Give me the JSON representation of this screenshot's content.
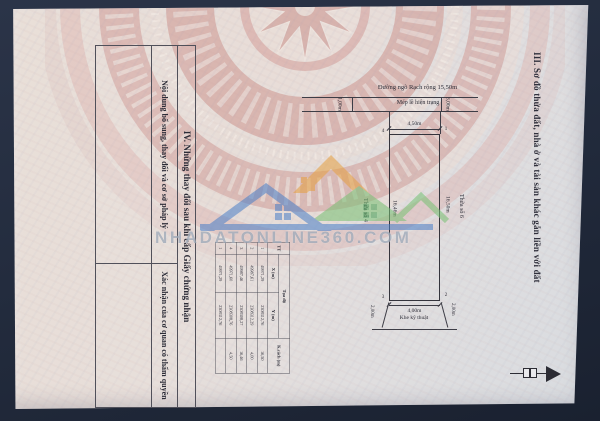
{
  "page": {
    "section3_title": "III. Sơ đồ thửa đất, nhà ở và tài sản khác gắn liền với đất",
    "section4": {
      "heading": "IV. Những thay đổi sau khi cấp Giấy chứng nhận",
      "col1": "Nội dung bổ sung, thay đổi và cơ sở pháp lý",
      "col2": "Xác nhận của cơ quan có thẩm quyền"
    },
    "diagram": {
      "road_label": "Đường ngõ Rạch rộng 15,50m",
      "edge_label": "Mép lề hiện trạng",
      "left_offset": "1,00m",
      "right_offset": "3,00m",
      "top_dim": "4,50m",
      "bottom_dim": "4,00m",
      "left_dim": "16,46m",
      "right_dim": "16,50m",
      "left_plot": "Thửa số 4",
      "right_plot": "Thửa số 6",
      "gap_left": "2,00m",
      "gap_right": "2,00m",
      "gap_label": "Khe kỹ thuật",
      "corners": {
        "tl": "4",
        "tr": "1",
        "bl": "3",
        "br": "2"
      }
    },
    "coord_table": {
      "tt_header": "TT",
      "toado_header": "Tọa độ",
      "x_header": "X (m)",
      "y_header": "Y (m)",
      "k_header": "K.cách (m)",
      "rows": [
        {
          "tt": "1",
          "x": "49971,29",
          "y": "2308312,76",
          "k": "16,50"
        },
        {
          "tt": "2",
          "x": "49987,61",
          "y": "2308312,29",
          "k": "4,00"
        },
        {
          "tt": "3",
          "x": "49987,46",
          "y": "2308308,27",
          "k": "16,46"
        },
        {
          "tt": "4",
          "x": "49971,60",
          "y": "2308308,76",
          "k": "4,50"
        },
        {
          "tt": "1",
          "x": "49971,29",
          "y": "2308312,76",
          "k": ""
        }
      ]
    }
  },
  "watermark": {
    "text": "NHADATONLINE360.COM"
  },
  "colors": {
    "background_navy": "#232c3e",
    "paper": "#e7ded9",
    "drum_pink": "#d2a09b",
    "watermark_blue": "#4a7fc8",
    "watermark_orange": "#e6a040",
    "watermark_green": "#77c173"
  }
}
